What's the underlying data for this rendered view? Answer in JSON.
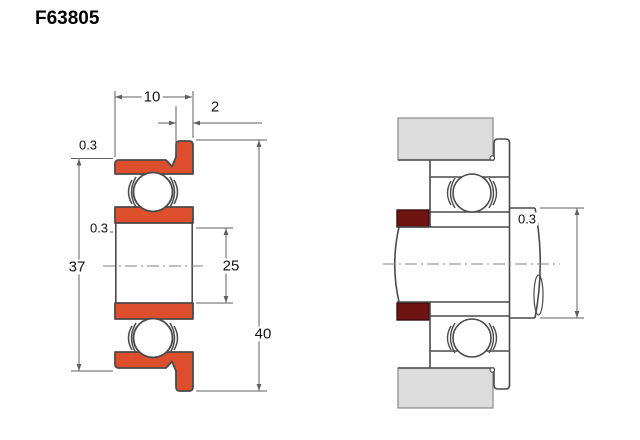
{
  "title": "F63805",
  "colors": {
    "ring_fill": "#dc4e2c",
    "spacer_fill": "#6e1212",
    "housing_fill": "#dcdcdc",
    "outline": "#4a4a4a",
    "dimension": "#5f5f5f"
  },
  "left_view": {
    "name": "flanged-bearing-cross-section",
    "dim_width": "10",
    "dim_flange_width": "2",
    "dim_chamfer_outer": "0.3",
    "dim_chamfer_bore": "0.3",
    "dim_outer_diameter": "37",
    "dim_bore_diameter": "25",
    "dim_flange_diameter": "40"
  },
  "right_view": {
    "name": "mounting-example",
    "dim_fillet_radius": "0.3"
  }
}
